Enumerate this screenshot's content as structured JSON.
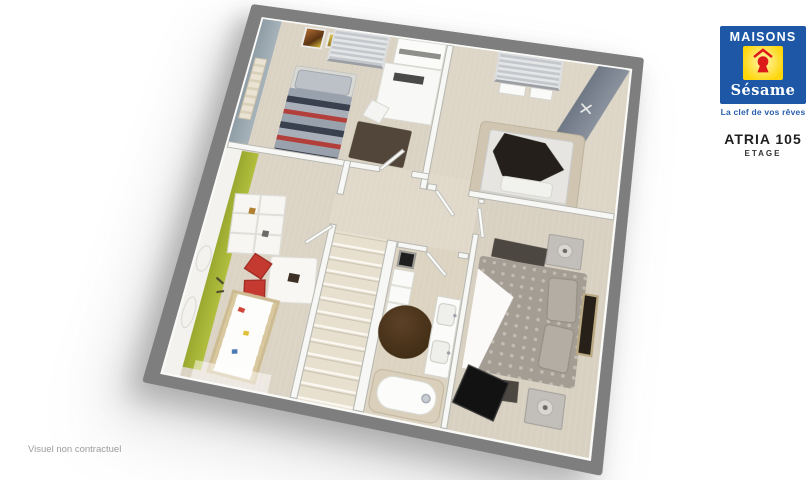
{
  "branding": {
    "logo": {
      "word_top": "MAISONS",
      "word_bottom": "Sésame",
      "icon": "keyhole-icon",
      "colors": {
        "blue": "#1d57a6",
        "yellow": "#ffd60a",
        "red": "#dc1a1a"
      }
    },
    "tagline": "La clef de vos rêves",
    "model_name": "ATRIA 105",
    "floor_label": "ETAGE"
  },
  "footer": {
    "disclaimer": "Visuel non contractuel"
  },
  "floorplan": {
    "colors": {
      "exterior_wall": "#7e7e7e",
      "interior_wall": "#f7f7f5",
      "carpet": "#ded6c7",
      "accent_blue_gray": "#9aa8b1",
      "accent_green": "#a4b236",
      "accent_dark_band": "#7a8390",
      "dark_rug_brown": "#46372a",
      "kids_chair_red": "#c43a31"
    },
    "rooms": [
      "bedroom-1",
      "bedroom-2",
      "kids-bedroom",
      "landing",
      "staircase",
      "bathroom",
      "master-bedroom"
    ]
  }
}
